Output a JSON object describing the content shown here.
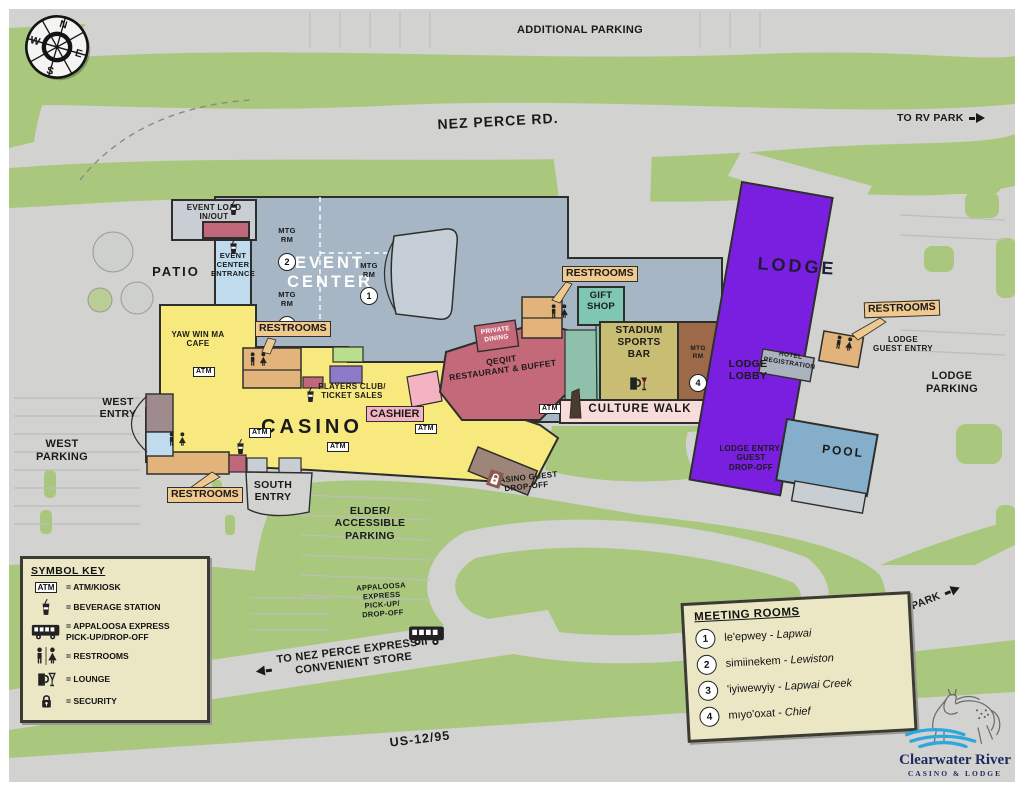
{
  "colors": {
    "base": "#d2d2d0",
    "green": "#a9c87e",
    "ink": "#1a1a1a",
    "ec": "#a6b6c5",
    "stage": "#c6cfd8",
    "load": "#c9ced4",
    "entr": "#c0dbee",
    "casino": "#f8e97e",
    "rose": "#c0687a",
    "rest": "#c4697a",
    "tan": "#e2b47b",
    "gift": "#7fc7b2",
    "tealmuted": "#8fc0ab",
    "bar": "#c9bd73",
    "mtg4": "#9c6a49",
    "culture": "#f8dcda",
    "lobby": "#8feadc",
    "lodge": "#7a1fe0",
    "hreg": "#a9b2bd",
    "pool": "#85aecb",
    "canopy": "#9d8679",
    "mauve": "#9f8a8e",
    "groom": "#b7df8c",
    "proom": "#8d7bca",
    "pinkbooth": "#f4b3c3",
    "cream": "#ebe7c5",
    "labelbox": "#efc98e",
    "navy": "#1b2a5e",
    "wave": "#2ea8dc"
  },
  "compass": {
    "n": "N",
    "e": "E",
    "s": "S",
    "w": "W"
  },
  "labels": {
    "additional_parking": "ADDITIONAL PARKING",
    "nez_perce_rd": "NEZ PERCE RD.",
    "to_rv_park": "TO RV PARK",
    "event_load": "EVENT LOAD\nIN/OUT",
    "event_center": "EVENT\nCENTER",
    "event_center_entrance": "EVENT\nCENTER\nENTRANCE",
    "mtg_rm": "MTG\nRM",
    "mtg_numbers": [
      "1",
      "2",
      "3",
      "4"
    ],
    "patio": "PATIO",
    "cafe": "YAW WIN MA\nCAFE",
    "restrooms": "RESTROOMS",
    "players_club": "PLAYERS CLUB/\nTICKET SALES",
    "cashier": "CASHIER",
    "casino": "CASINO",
    "west_entry": "WEST\nENTRY",
    "west_parking": "WEST\nPARKING",
    "south_entry": "SOUTH\nENTRY",
    "elder_parking": "ELDER/\nACCESSIBLE\nPARKING",
    "private_dining": "PRIVATE\nDINING",
    "qeqiit": "QEQIIT\nRESTAURANT & BUFFET",
    "gift_shop": "GIFT\nSHOP",
    "stadium": "STADIUM\nSPORTS\nBAR",
    "culture_walk": "CULTURE WALK",
    "casino_dropoff": "CASINO GUEST\nDROP-OFF",
    "lodge": "LODGE",
    "hotel_registration": "HOTEL\nREGISTRATION",
    "lodge_guest_entry": "LODGE\nGUEST ENTRY",
    "lodge_parking": "LODGE\nPARKING",
    "lodge_lobby": "LODGE\nLOBBY",
    "lodge_entry_dropoff": "LODGE ENTRY/\nGUEST\nDROP-OFF",
    "pool": "POOL",
    "appaloosa": "APPALOOSA\nEXPRESS\nPICK-UP/\nDROP-OFF",
    "to_nez_perce": "TO NEZ PERCE EXPRESS II\nCONVENIENT STORE",
    "us_12_95": "US-12/95",
    "atm": "ATM"
  },
  "symbol_key": {
    "title": "SYMBOL KEY",
    "atm_label": "ATM",
    "items": [
      {
        "icon": "atm-icon",
        "text": "= ATM/KIOSK"
      },
      {
        "icon": "beverage-icon",
        "text": "= BEVERAGE STATION"
      },
      {
        "icon": "bus-icon",
        "text": "= APPALOOSA EXPRESS\nPICK-UP/DROP-OFF"
      },
      {
        "icon": "restrooms-icon",
        "text": "= RESTROOMS"
      },
      {
        "icon": "lounge-icon",
        "text": "= LOUNGE"
      },
      {
        "icon": "security-icon",
        "text": "= SECURITY"
      }
    ]
  },
  "meeting_rooms": {
    "title": "MEETING ROOMS",
    "rooms": [
      {
        "num": "1",
        "name": "le'epwey -",
        "place": "Lapwai"
      },
      {
        "num": "2",
        "name": "simiinekem -",
        "place": "Lewiston"
      },
      {
        "num": "3",
        "name": "'iyiwewyiy -",
        "place": "Lapwai Creek"
      },
      {
        "num": "4",
        "name": "mıyo'oxat -",
        "place": "Chief"
      }
    ]
  },
  "logo": {
    "line1": "Clearwater River",
    "line2": "CASINO & LODGE"
  }
}
